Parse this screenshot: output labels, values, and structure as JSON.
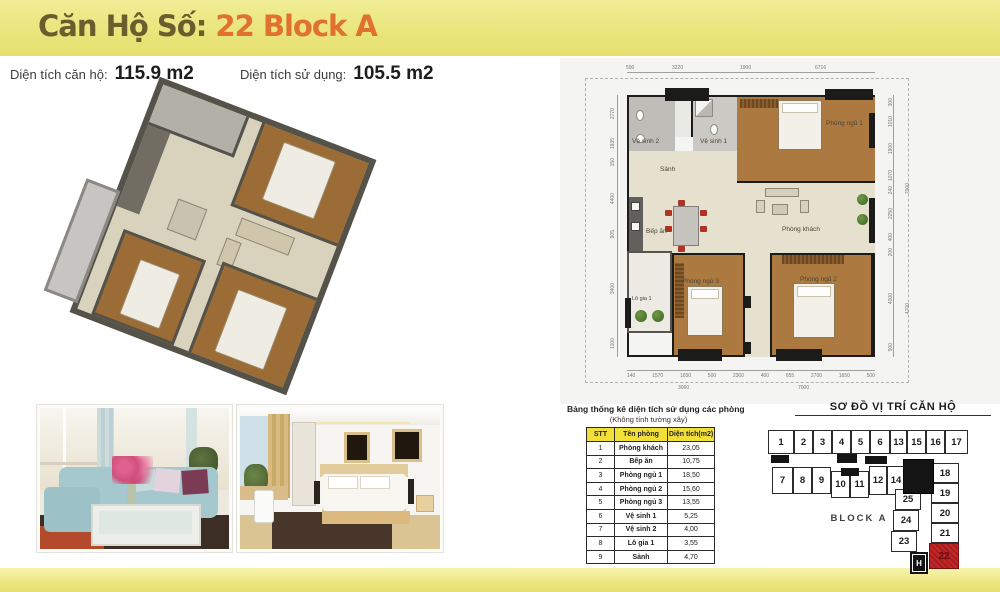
{
  "header": {
    "title_prefix": "Căn Hộ Số:",
    "title_unit": "22 Block A",
    "area1_label": "Diện tích căn hộ:",
    "area1_value": "115.9 m2",
    "area2_label": "Diện tích sử dụng:",
    "area2_value": "105.5 m2"
  },
  "plan": {
    "rooms": {
      "ve_sinh_2": "Vệ sinh 2",
      "ve_sinh_1": "Vệ sinh 1",
      "phong_ngu_1": "Phòng ngủ 1",
      "sanh": "Sảnh",
      "bep_an": "Bếp ăn",
      "phong_khach": "Phòng khách",
      "phong_ngu_3": "Phòng ngủ 3",
      "phong_ngu_2": "Phòng ngủ 2",
      "lo_gia_1": "Lô gia 1"
    },
    "dims_top": [
      "590",
      "3220",
      "1900",
      "6716"
    ],
    "dims_right": [
      "300",
      "1010",
      "1900",
      "1070",
      "240",
      "2250",
      "400",
      "200",
      "4000",
      "500"
    ],
    "dims_right_totals": [
      "7000",
      "4700"
    ],
    "dims_bottom": [
      "140",
      "1570",
      "1650",
      "500",
      "2300",
      "400",
      "655",
      "2700",
      "1650",
      "500"
    ],
    "dims_bottom_totals": [
      "3060",
      "7000"
    ],
    "dims_left": [
      "2770",
      "1935",
      "150",
      "4400",
      "905",
      "3400",
      "1100"
    ]
  },
  "table": {
    "title": "Bảng thống kê diện tích sử dụng các phòng",
    "subtitle": "(Không tính tường xây)",
    "headers": [
      "STT",
      "Tên phòng",
      "Diện tích(m2)"
    ],
    "rows": [
      [
        "1",
        "Phòng khách",
        "23,05"
      ],
      [
        "2",
        "Bếp ăn",
        "10,75"
      ],
      [
        "3",
        "Phòng ngủ 1",
        "18,50"
      ],
      [
        "4",
        "Phòng ngủ 2",
        "15,60"
      ],
      [
        "5",
        "Phòng ngủ 3",
        "13,55"
      ],
      [
        "6",
        "Vệ sinh 1",
        "5,25"
      ],
      [
        "7",
        "Vệ sinh 2",
        "4,00"
      ],
      [
        "8",
        "Lô gia 1",
        "3,55"
      ],
      [
        "9",
        "Sảnh",
        "4,70"
      ]
    ]
  },
  "location": {
    "title": "SƠ ĐỒ VỊ TRÍ CĂN HỘ",
    "block_label": "BLOCK A",
    "elevator_label": "H",
    "highlighted_unit": "22",
    "row1": [
      "1",
      "2",
      "3",
      "4",
      "5",
      "6",
      "13",
      "15",
      "16",
      "17"
    ],
    "row2": [
      "7",
      "8",
      "9",
      "10",
      "11",
      "12",
      "14"
    ],
    "mid_col": [
      "25",
      "24",
      "23"
    ],
    "right_col": [
      "18",
      "19",
      "20",
      "21",
      "22"
    ]
  },
  "colors": {
    "banner_yellow": "#e9e478",
    "title_olive": "#6a5d2e",
    "title_orange": "#e0712f",
    "highlight_red": "#c62626",
    "table_header_yellow": "#f2df3a",
    "wood_floor": "#ac7a41",
    "interior_beige": "#e6e1ce",
    "wall_black": "#1b1b19"
  }
}
